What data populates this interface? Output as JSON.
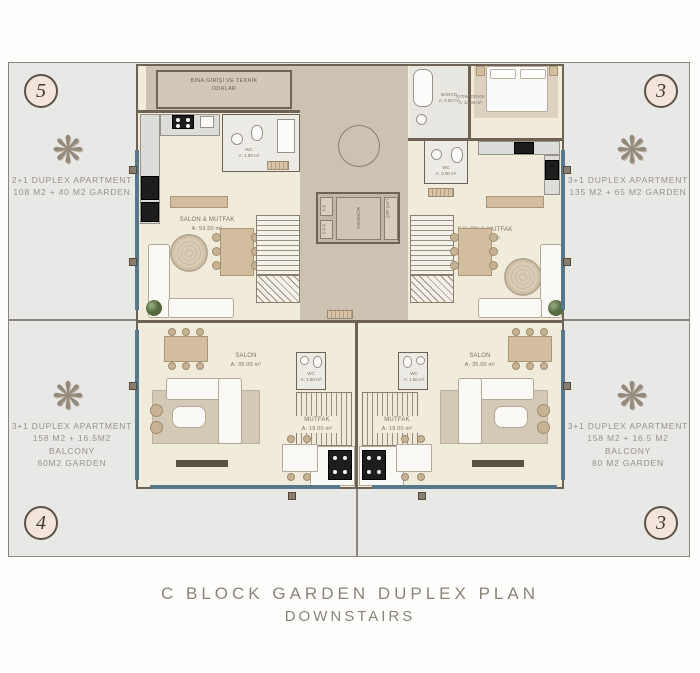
{
  "page": {
    "title_line1": "C BLOCK GARDEN DUPLEX PLAN",
    "title_line2": "DOWNSTAIRS"
  },
  "badges": {
    "top_left": "5",
    "top_right": "3",
    "bottom_left": "4",
    "bottom_right": "3"
  },
  "tree_glyph": "❋",
  "gardens": {
    "top_left": {
      "line1": "2+1 DUPLEX APARTMENT",
      "line2": "108 M2 + 40 M2 GARDEN"
    },
    "top_right": {
      "line1": "3+1 DUPLEX APARTMENT",
      "line2": "135 M2 + 65 M2 GARDEN"
    },
    "bottom_left": {
      "line1": "3+1 DUPLEX APARTMENT",
      "line2": "158 M2 + 16.5M2 BALCONY",
      "line3": "60M2 GARDEN"
    },
    "bottom_right": {
      "line1": "3+1 DUPLEX APARTMENT",
      "line2": "158 M2 + 16.5 M2 BALCONY",
      "line3": "80 M2 GARDEN"
    }
  },
  "rooms": {
    "entrance_line1": "BİNA GİRİŞİ VE TEKNİK",
    "entrance_line2": "ODALAR",
    "upper_left_salon_name": "SALON & MUTFAK",
    "upper_left_salon_area": "A: 53.50 m²",
    "upper_left_wc_name": "WC",
    "upper_left_wc_area": "A: 1.80 m²",
    "upper_right_salon_name": "SALON & MUTFAK",
    "upper_right_salon_area": "A: 56.50 m²",
    "banyo_name": "BANYO",
    "banyo_area": "A: 4.50 m²",
    "bedroom_name": "YATAK ODASI",
    "bedroom_area": "A: 14.00 m²",
    "upper_right_wc_name": "WC",
    "upper_right_wc_area": "A: 3.00 m²",
    "lower_left_salon_name": "SALON",
    "lower_left_salon_area": "A: 35.00 m²",
    "lower_left_mutfak_name": "MUTFAK",
    "lower_left_mutfak_area": "A: 19.00 m²",
    "lower_left_wc_name": "WC",
    "lower_left_wc_area": "A: 1.50 m²",
    "lower_right_salon_name": "SALON",
    "lower_right_salon_area": "A: 35.00 m²",
    "lower_right_mutfak_name": "MUTFAK",
    "lower_right_mutfak_area": "A: 19.00 m²",
    "lower_right_wc_name": "WC",
    "lower_right_wc_area": "A: 1.50 m²",
    "core_label": "ASANSÖR",
    "shaft_left_top": "K.Ş",
    "shaft_left_bottom": "Ç.A.Ş",
    "shaft_right": "ÇÖP ŞAFT"
  },
  "colors": {
    "accent_teal": "#56788a",
    "wall": "#6e6254",
    "garden": "#e8e8e6",
    "floor": "#f1ebdc",
    "corridor": "#cdc2b2",
    "badge_fill": "#f4e5dc",
    "badge_border": "#5c5145",
    "title_text": "#8c8376"
  }
}
